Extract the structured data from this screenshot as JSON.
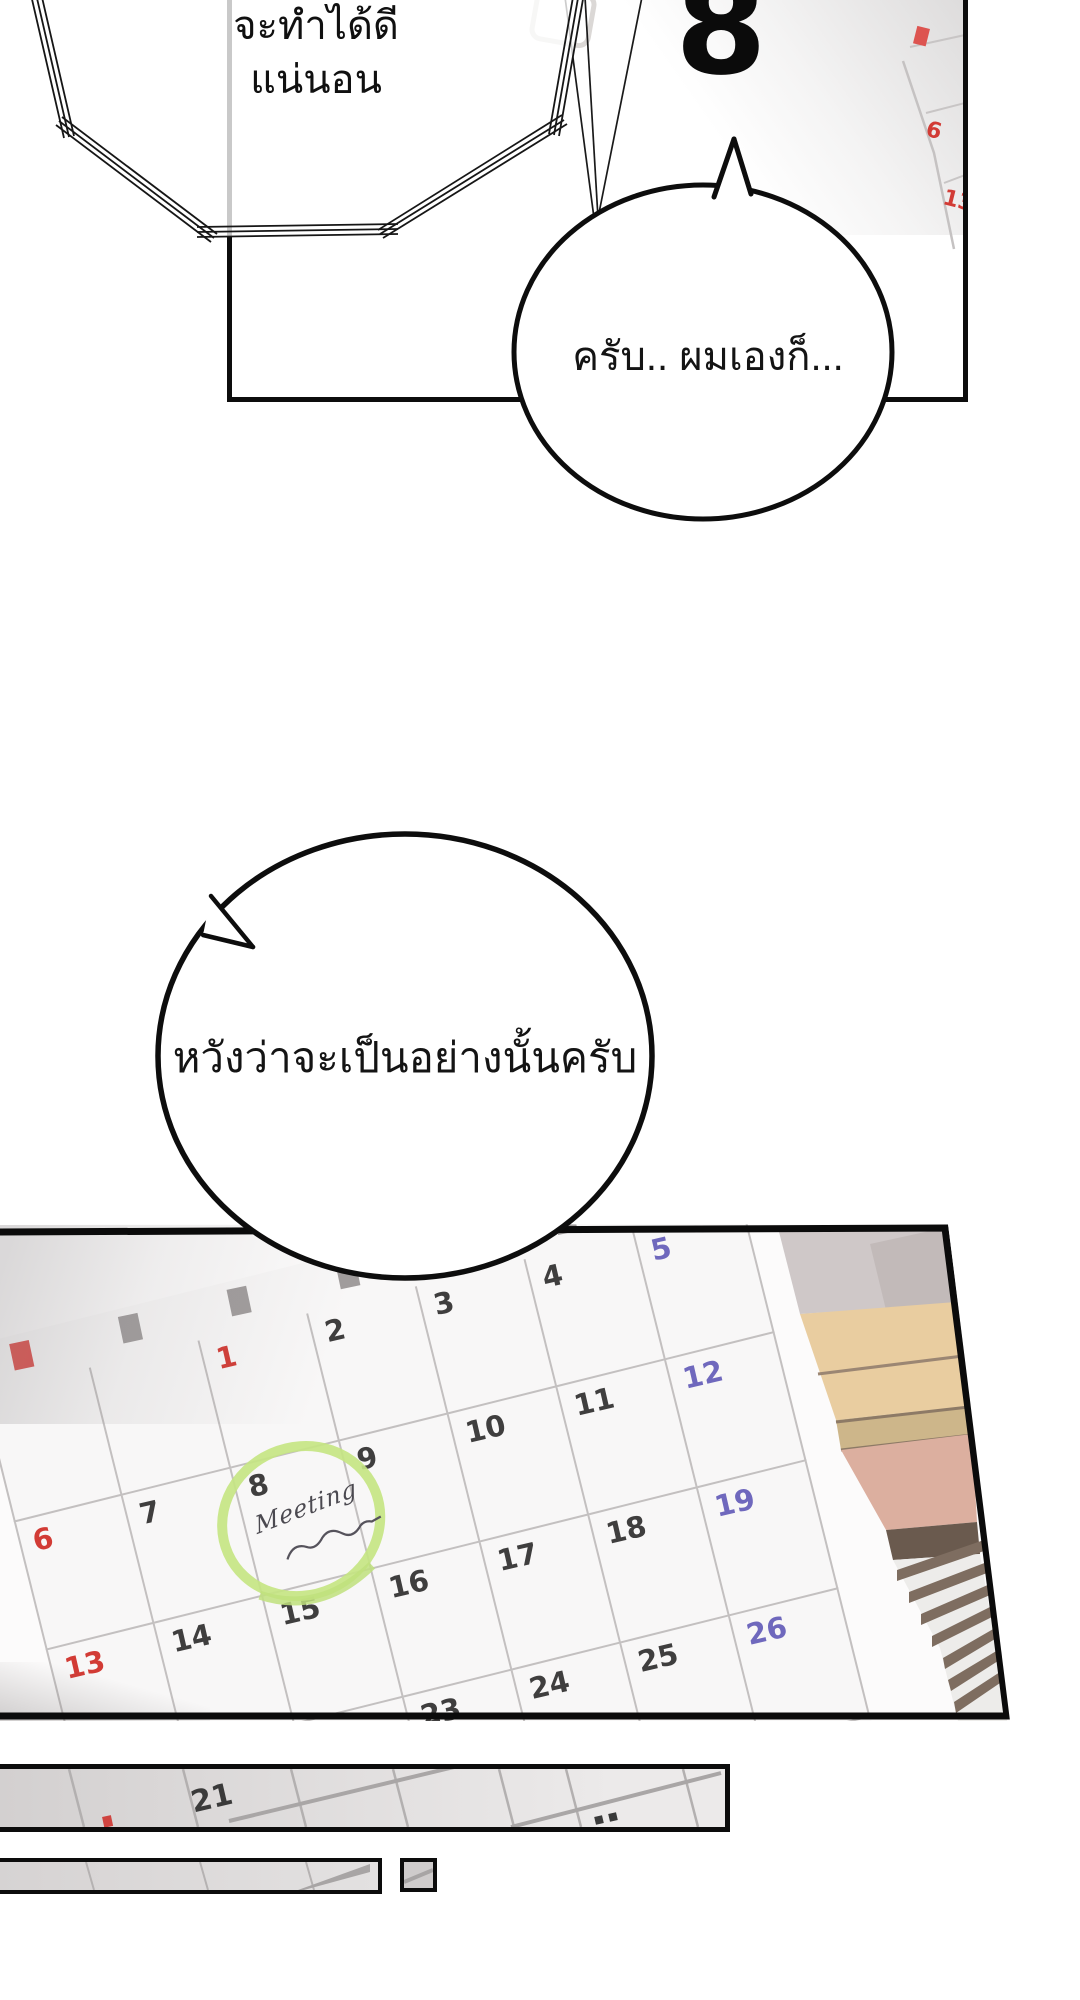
{
  "page": {
    "background": "#ffffff",
    "line_color": "#0d0d0d"
  },
  "top_panel": {
    "flashback_bubble": {
      "line1": "จะทำได้ดี",
      "line2": "แน่นอน"
    },
    "date_sheet_number": "8",
    "speech_bubble_text": "ครับ.. ผมเองก็...",
    "side_calendar": {
      "date1": "6",
      "date2": "13",
      "accent": "#d23b35"
    }
  },
  "middle_bubble": {
    "text": "หวังว่าจะเป็นอย่างนั้นครับ"
  },
  "calendar_panel": {
    "weekday_header_colors": [
      "red",
      "gray",
      "gray",
      "gray",
      "gray",
      "gray",
      "gray"
    ],
    "weeks": [
      [
        "",
        "",
        "1r",
        "2",
        "3",
        "4",
        "5b"
      ],
      [
        "6r",
        "7",
        "8",
        "9",
        "10",
        "11",
        "12b"
      ],
      [
        "13r",
        "14",
        "15",
        "16",
        "17",
        "18",
        "19b"
      ],
      [
        "20r",
        "21",
        "22",
        "23",
        "24",
        "25",
        "26b"
      ]
    ],
    "annotation": {
      "line1": "Meeting"
    },
    "colors": {
      "sunday": "#d23b35",
      "saturday": "#6f68bd",
      "weekday": "#3f3e3e",
      "grid": "#c3c0c0",
      "highlight_circle": "#c6e583"
    }
  },
  "bottom_strips": {
    "strip1_date": "21"
  }
}
